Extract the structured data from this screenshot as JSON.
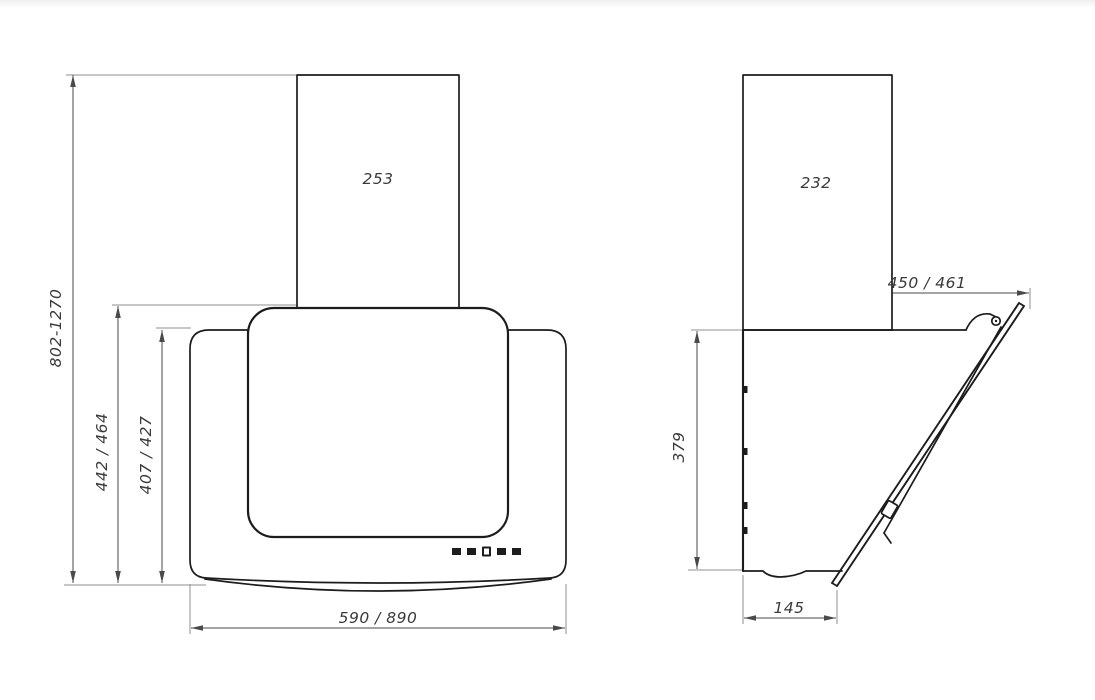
{
  "drawing": {
    "title": "cooker-hood-dimensional-drawing",
    "views": {
      "front_view_name": "front view",
      "side_view_name": "side view"
    },
    "front_view": {
      "dim_duct_width": "253",
      "dim_mounting_height_range": "802-1270",
      "dim_body_height_total": "442 / 464",
      "dim_body_height_front": "407 / 427",
      "dim_body_width": "590 / 890",
      "control_button_count": 5
    },
    "side_view": {
      "dim_duct_depth": "232",
      "dim_total_depth": "450 / 461",
      "dim_body_height": "379",
      "dim_bottom_depth": "145"
    },
    "colors": {
      "object_line": "#1c1c1c",
      "dimension_line": "#4a4a4a",
      "extension_line": "#8f8f8f",
      "text": "#3a3a3a",
      "background": "#ffffff",
      "top_strip": "#efefef"
    }
  }
}
